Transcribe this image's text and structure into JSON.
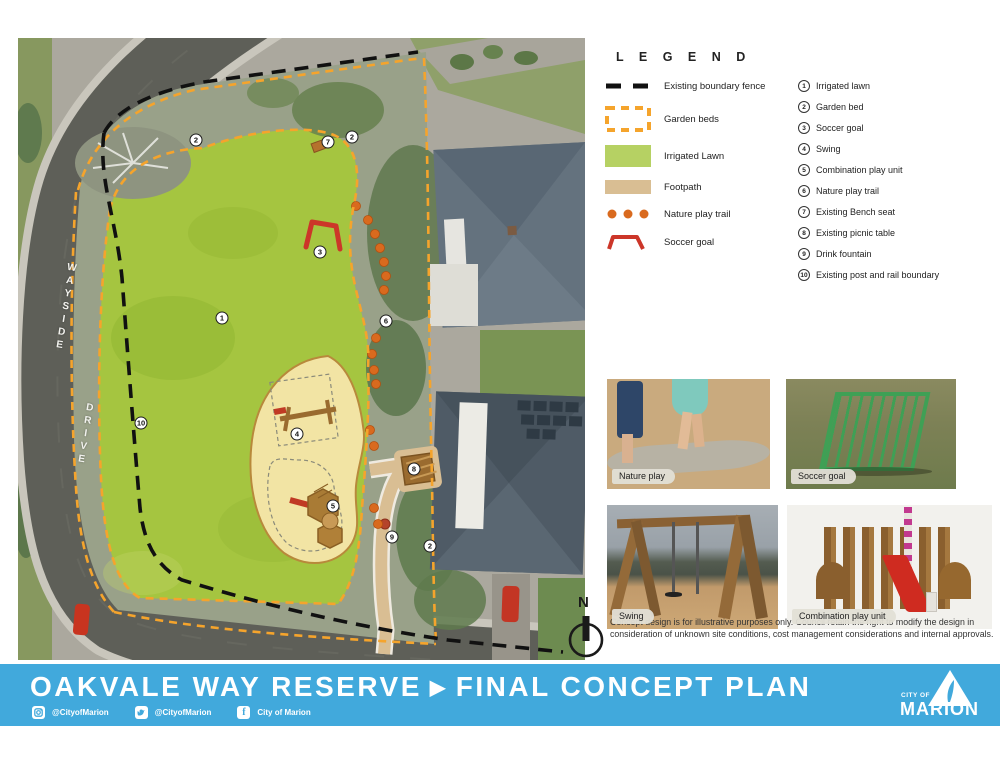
{
  "map": {
    "street_name": "WAYSIDE DRIVE",
    "markers": [
      {
        "num": "1",
        "x": 204,
        "y": 280
      },
      {
        "num": "2",
        "x": 178,
        "y": 102
      },
      {
        "num": "7",
        "x": 310,
        "y": 104
      },
      {
        "num": "2",
        "x": 334,
        "y": 99
      },
      {
        "num": "3",
        "x": 302,
        "y": 214
      },
      {
        "num": "6",
        "x": 368,
        "y": 283
      },
      {
        "num": "10",
        "x": 123,
        "y": 385
      },
      {
        "num": "4",
        "x": 279,
        "y": 396
      },
      {
        "num": "5",
        "x": 315,
        "y": 468
      },
      {
        "num": "8",
        "x": 396,
        "y": 431
      },
      {
        "num": "9",
        "x": 374,
        "y": 499
      },
      {
        "num": "2",
        "x": 412,
        "y": 508
      }
    ]
  },
  "legend": {
    "title": "L E G E N D",
    "symbols": [
      {
        "id": "existing-boundary-fence",
        "label": "Existing boundary fence"
      },
      {
        "id": "garden-beds",
        "label": "Garden beds"
      },
      {
        "id": "irrigated-lawn",
        "label": "Irrigated Lawn"
      },
      {
        "id": "footpath",
        "label": "Footpath"
      },
      {
        "id": "nature-play-trail",
        "label": "Nature play trail"
      },
      {
        "id": "soccer-goal",
        "label": "Soccer goal"
      }
    ],
    "items": [
      {
        "num": "1",
        "label": "Irrigated lawn"
      },
      {
        "num": "2",
        "label": "Garden bed"
      },
      {
        "num": "3",
        "label": "Soccer goal"
      },
      {
        "num": "4",
        "label": "Swing"
      },
      {
        "num": "5",
        "label": "Combination play unit"
      },
      {
        "num": "6",
        "label": "Nature play trail"
      },
      {
        "num": "7",
        "label": "Existing Bench seat"
      },
      {
        "num": "8",
        "label": "Existing picnic table"
      },
      {
        "num": "9",
        "label": "Drink fountain"
      },
      {
        "num": "10",
        "label": "Existing post and rail boundary"
      }
    ]
  },
  "photos": [
    {
      "caption": "Nature play"
    },
    {
      "caption": "Soccer goal"
    },
    {
      "caption": "Swing"
    },
    {
      "caption": "Combination play unit"
    }
  ],
  "north_label": "N",
  "disclaimer": "Concept design is for illustrative purposes only.  Council retain the right to modify the design in consideration of unknown site conditions, cost management considerations and internal approvals.",
  "banner": {
    "title": "OAKVALE WAY RESERVE",
    "separator": "▶",
    "subtitle": "FINAL CONCEPT PLAN",
    "social": [
      {
        "network": "instagram",
        "handle": "@CityofMarion"
      },
      {
        "network": "twitter",
        "handle": "@CityofMarion"
      },
      {
        "network": "facebook",
        "handle": "City of Marion"
      }
    ],
    "logo": {
      "top": "CITY OF",
      "name": "MARION"
    }
  },
  "colors": {
    "banner_blue": "#41a9dc",
    "lawn_green": "#a5c540",
    "playground_yellow": "#f2e4a4",
    "footpath_tan": "#d9be93",
    "garden_bed_orange": "#f5a42c",
    "nature_trail_orange": "#d96a1e",
    "soccer_goal_red": "#cc3629",
    "fence_black": "#111111"
  }
}
